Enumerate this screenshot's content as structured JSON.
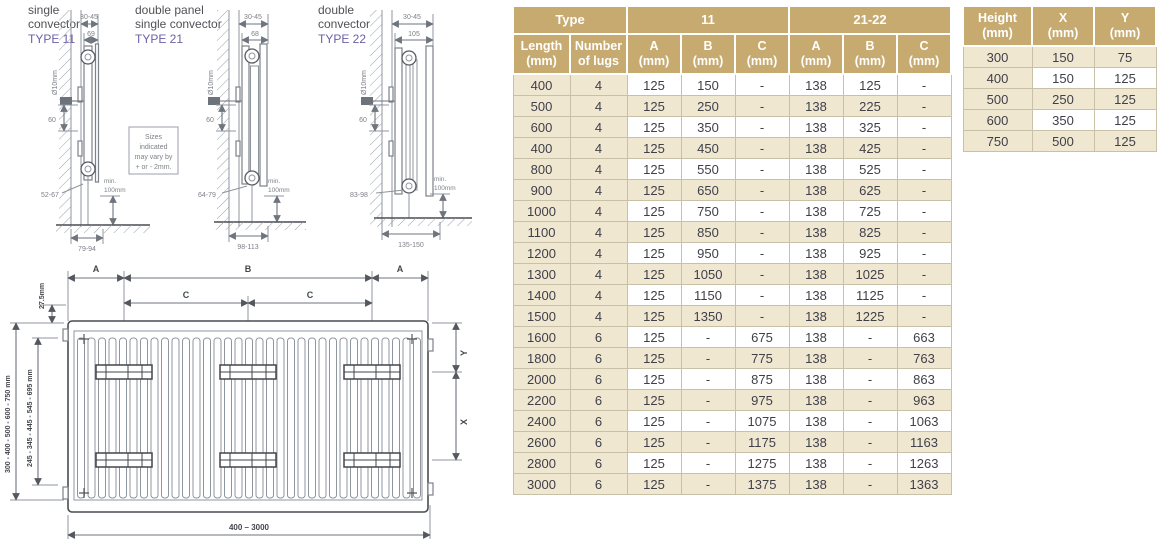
{
  "palette": {
    "header_bg": "#c7aa70",
    "row_beige": "#f0e7d1",
    "type_label": "#6c5fa7",
    "cell_text": "#3f3f4a",
    "header_text": "#ffffff"
  },
  "diagrams": {
    "type11": {
      "title1": "single",
      "title2": "convector",
      "type": "TYPE 11",
      "dim_top": "30-45",
      "dim_depth": "69",
      "valve": "Ø10mm",
      "dim_sixty": "60",
      "dim_bottom": "52-67",
      "min_clearance_1": "min.",
      "min_clearance_2": "100mm",
      "dim_overall": "79-94"
    },
    "type21": {
      "title1": "double panel",
      "title2": "single convector",
      "type": "TYPE 21",
      "dim_top": "30-45",
      "dim_depth": "68",
      "valve": "Ø10mm",
      "dim_sixty": "60",
      "dim_bottom": "64-79",
      "min_clearance_1": "min.",
      "min_clearance_2": "100mm",
      "dim_overall": "98-113"
    },
    "type22": {
      "title1": "double",
      "title2": "convector",
      "type": "TYPE 22",
      "dim_top": "30-45",
      "dim_depth": "105",
      "valve": "Ø10mm",
      "dim_sixty": "60",
      "dim_bottom": "83-98",
      "min_clearance_1": "min.",
      "min_clearance_2": "100mm",
      "dim_overall": "135-150"
    },
    "note": {
      "line1": "Sizes",
      "line2": "indicated",
      "line3": "may vary by",
      "line4": "+ or - 2mm."
    }
  },
  "front_view": {
    "dim_a_left": "A",
    "dim_b": "B",
    "dim_a_right": "A",
    "dim_c_left": "C",
    "dim_c_right": "C",
    "dim_offset": "27.5mm",
    "heights_outer": "300 - 400 - 500 - 600 - 750 mm",
    "heights_inner": "245 - 345 - 445 - 545 - 695 mm",
    "dim_y": "Y",
    "dim_x": "X",
    "length_range": "400 – 3000"
  },
  "main_table": {
    "group_headers": [
      "Type",
      "11",
      "21-22"
    ],
    "col_headers": [
      "Length\n(mm)",
      "Number\nof lugs",
      "A\n(mm)",
      "B\n(mm)",
      "C\n(mm)",
      "A\n(mm)",
      "B\n(mm)",
      "C\n(mm)"
    ],
    "rows": [
      [
        "400",
        "4",
        "125",
        "150",
        "-",
        "138",
        "125",
        "-"
      ],
      [
        "500",
        "4",
        "125",
        "250",
        "-",
        "138",
        "225",
        "-"
      ],
      [
        "600",
        "4",
        "125",
        "350",
        "-",
        "138",
        "325",
        "-"
      ],
      [
        "400",
        "4",
        "125",
        "450",
        "-",
        "138",
        "425",
        "-"
      ],
      [
        "800",
        "4",
        "125",
        "550",
        "-",
        "138",
        "525",
        "-"
      ],
      [
        "900",
        "4",
        "125",
        "650",
        "-",
        "138",
        "625",
        "-"
      ],
      [
        "1000",
        "4",
        "125",
        "750",
        "-",
        "138",
        "725",
        "-"
      ],
      [
        "1100",
        "4",
        "125",
        "850",
        "-",
        "138",
        "825",
        "-"
      ],
      [
        "1200",
        "4",
        "125",
        "950",
        "-",
        "138",
        "925",
        "-"
      ],
      [
        "1300",
        "4",
        "125",
        "1050",
        "-",
        "138",
        "1025",
        "-"
      ],
      [
        "1400",
        "4",
        "125",
        "1150",
        "-",
        "138",
        "1125",
        "-"
      ],
      [
        "1500",
        "4",
        "125",
        "1350",
        "-",
        "138",
        "1225",
        "-"
      ],
      [
        "1600",
        "6",
        "125",
        "-",
        "675",
        "138",
        "-",
        "663"
      ],
      [
        "1800",
        "6",
        "125",
        "-",
        "775",
        "138",
        "-",
        "763"
      ],
      [
        "2000",
        "6",
        "125",
        "-",
        "875",
        "138",
        "-",
        "863"
      ],
      [
        "2200",
        "6",
        "125",
        "-",
        "975",
        "138",
        "-",
        "963"
      ],
      [
        "2400",
        "6",
        "125",
        "-",
        "1075",
        "138",
        "-",
        "1063"
      ],
      [
        "2600",
        "6",
        "125",
        "-",
        "1175",
        "138",
        "-",
        "1163"
      ],
      [
        "2800",
        "6",
        "125",
        "-",
        "1275",
        "138",
        "-",
        "1263"
      ],
      [
        "3000",
        "6",
        "125",
        "-",
        "1375",
        "138",
        "-",
        "1363"
      ]
    ]
  },
  "side_table": {
    "col_headers": [
      "Height\n(mm)",
      "X\n(mm)",
      "Y\n(mm)"
    ],
    "rows": [
      [
        "300",
        "150",
        "75"
      ],
      [
        "400",
        "150",
        "125"
      ],
      [
        "500",
        "250",
        "125"
      ],
      [
        "600",
        "350",
        "125"
      ],
      [
        "750",
        "500",
        "125"
      ]
    ]
  }
}
